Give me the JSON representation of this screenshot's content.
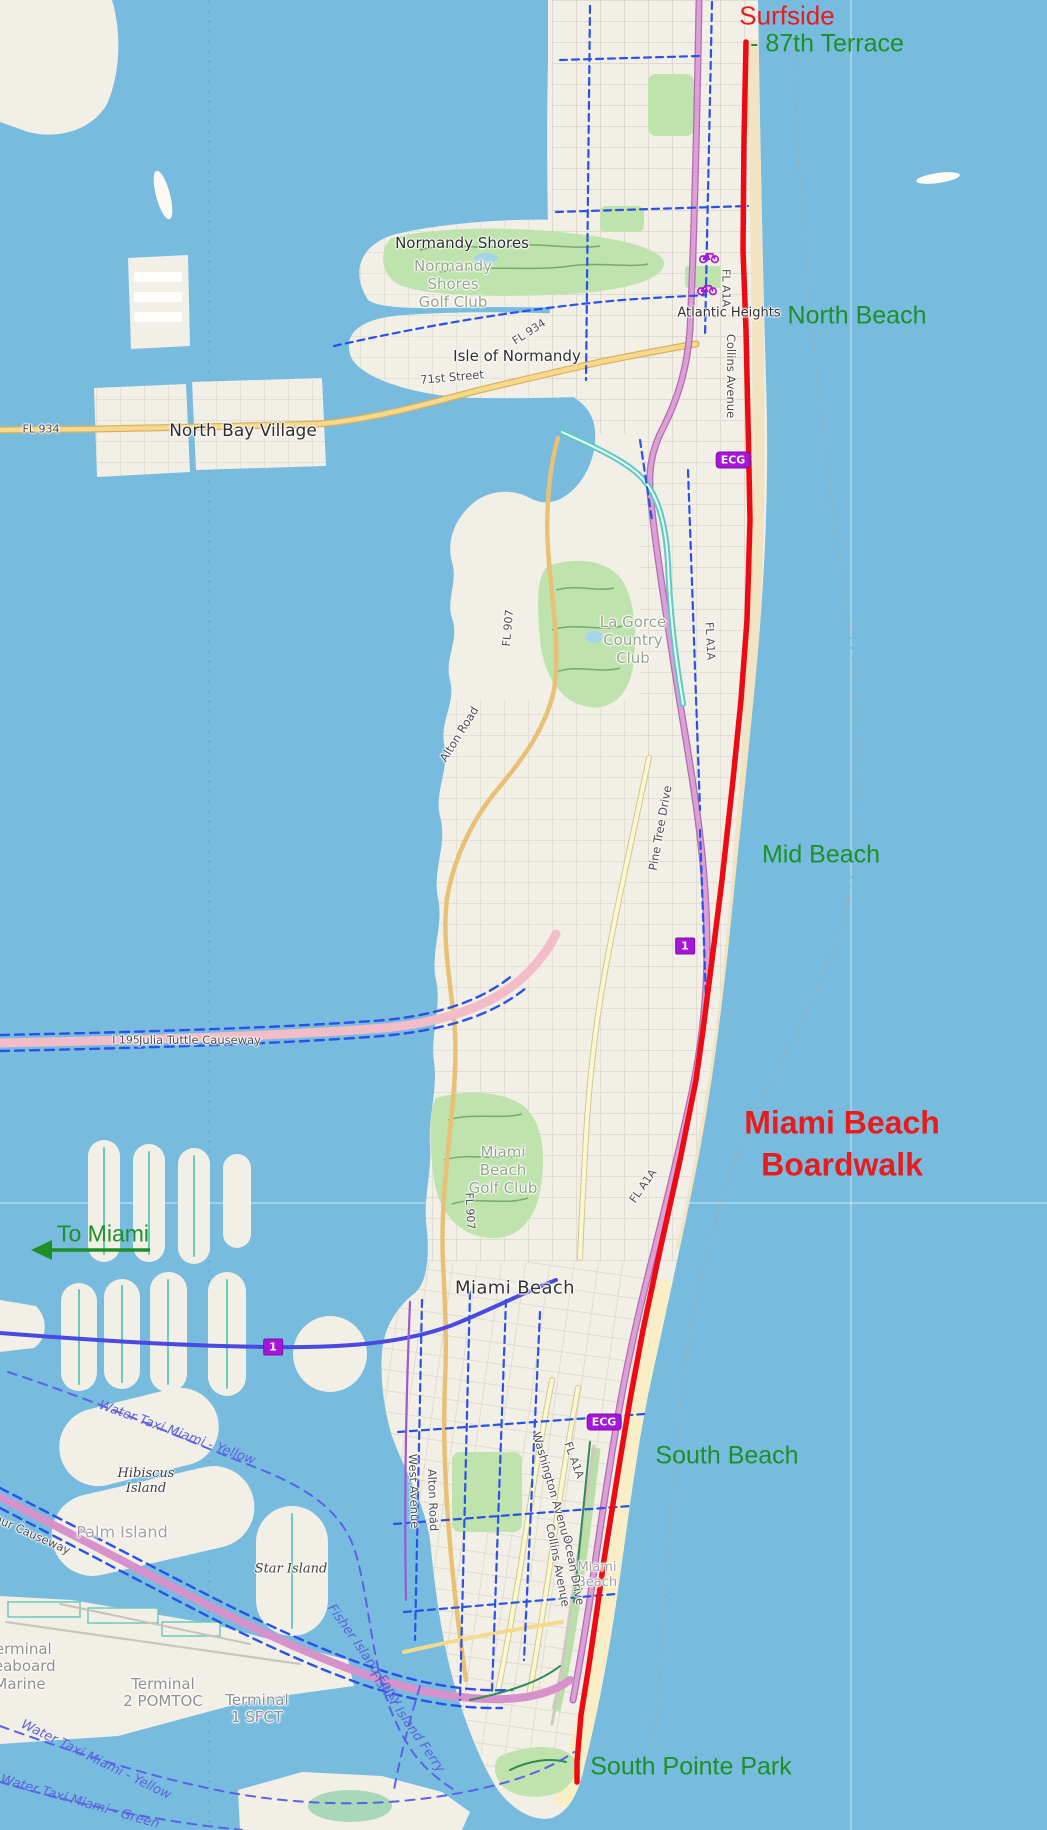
{
  "meta": {
    "width": 1047,
    "height": 1830,
    "description": "Annotated OpenStreetMap-style map of Miami Beach showing the Miami Beach Boardwalk route in red from Surfside / 87th Terrace to South Pointe Park"
  },
  "map": {
    "colors": {
      "water": "#77bbdf",
      "land": "#f2efe6",
      "sand": "#f2e3c2",
      "sand_south": "#faeec6",
      "park": "#bfe3ad",
      "golf_contour": "#7aa96c",
      "road_yellow": "#f6d98c",
      "road_pale": "#faf7d2",
      "road_mauve": "#dba0d6",
      "causeway_pink": "#f2bcc9",
      "causeway_magenta": "#d892cb",
      "teal_road": "#5ecac0",
      "bike_blue": "#2a52e8",
      "taxi_blue": "#5b62e8",
      "boardwalk_red": "#ee0a12",
      "annotation_red": "#e81c1c",
      "annotation_green": "#1d9027",
      "badge_purple": "#a615d8",
      "grid": "#d9d3c8"
    },
    "labels": [
      {
        "n": "annotation-surfside",
        "t": "Surfside",
        "x": 787,
        "y": 16,
        "r": "ann-red"
      },
      {
        "n": "annotation-87th-terrace",
        "t": "- 87th Terrace",
        "x": 827,
        "y": 44,
        "r": "ann-green"
      },
      {
        "n": "annotation-north-beach",
        "t": "North Beach",
        "x": 857,
        "y": 316,
        "r": "ann-green"
      },
      {
        "n": "annotation-mid-beach",
        "t": "Mid Beach",
        "x": 821,
        "y": 855,
        "r": "ann-green"
      },
      {
        "n": "annotation-boardwalk-title",
        "t": "Miami Beach\nBoardwalk",
        "x": 842,
        "y": 1144,
        "r": "ann-red-big"
      },
      {
        "n": "annotation-to-miami",
        "t": "To Miami",
        "x": 103,
        "y": 1234,
        "r": "ann-green",
        "s": 23
      },
      {
        "n": "annotation-south-beach",
        "t": "South Beach",
        "x": 727,
        "y": 1456,
        "r": "ann-green"
      },
      {
        "n": "annotation-south-pointe-park",
        "t": "South Pointe Park",
        "x": 691,
        "y": 1767,
        "r": "ann-green"
      },
      {
        "n": "label-normandy-shores",
        "t": "Normandy Shores",
        "x": 462,
        "y": 243,
        "r": "place halo"
      },
      {
        "n": "label-normandy-shores-golf-club",
        "t": "Normandy\nShores\nGolf Club",
        "x": 453,
        "y": 284,
        "r": "golf halo"
      },
      {
        "n": "label-isle-of-normandy",
        "t": "Isle of Normandy",
        "x": 517,
        "y": 356,
        "r": "place halo"
      },
      {
        "n": "label-north-bay-village",
        "t": "North Bay Village",
        "x": 243,
        "y": 431,
        "r": "place-lg halo"
      },
      {
        "n": "label-atlantic-heights",
        "t": "Atlantic Heights",
        "x": 729,
        "y": 313,
        "r": "place-sm halo"
      },
      {
        "n": "label-miami-beach-city",
        "t": "Miami Beach",
        "x": 515,
        "y": 1288,
        "r": "city halo"
      },
      {
        "n": "label-miami-beach-faint",
        "t": "Miami\nBeach",
        "x": 597,
        "y": 1575,
        "r": "suburb-faint halo",
        "s": 13
      },
      {
        "n": "label-la-gorce-country-club",
        "t": "La Gorce\nCountry\nClub",
        "x": 633,
        "y": 640,
        "r": "golf halo"
      },
      {
        "n": "label-miami-beach-golf-club",
        "t": "Miami\nBeach\nGolf Club",
        "x": 503,
        "y": 1170,
        "r": "golf halo"
      },
      {
        "n": "label-hibiscus-island",
        "t": "Hibiscus\nIsland",
        "x": 146,
        "y": 1481,
        "r": "island halo"
      },
      {
        "n": "label-palm-island",
        "t": "Palm Island",
        "x": 122,
        "y": 1532,
        "r": "suburb-faint halo"
      },
      {
        "n": "label-star-island",
        "t": "Star Island",
        "x": 291,
        "y": 1569,
        "r": "island halo"
      },
      {
        "n": "label-terminal-seaboard-marine",
        "t": "Terminal\nSeaboard\nMarine",
        "x": 20,
        "y": 1667,
        "r": "terminal halo"
      },
      {
        "n": "label-terminal-2-pomtoc",
        "t": "Terminal\n2 POMTOC",
        "x": 163,
        "y": 1693,
        "r": "terminal halo"
      },
      {
        "n": "label-terminal-1-sfct",
        "t": "Terminal\n1 SFCT",
        "x": 257,
        "y": 1709,
        "r": "terminal halo"
      },
      {
        "n": "label-71st-street",
        "t": "71st Street",
        "x": 452,
        "y": 377,
        "r": "road halo",
        "rot": -5
      },
      {
        "n": "label-fl-934-isle",
        "t": "FL 934",
        "x": 529,
        "y": 332,
        "r": "ref halo",
        "rot": -33
      },
      {
        "n": "label-fl-934-west",
        "t": "FL 934",
        "x": 41,
        "y": 429,
        "r": "ref halo"
      },
      {
        "n": "label-collins-avenue-north",
        "t": "Collins Avenue",
        "x": 731,
        "y": 376,
        "r": "road halo",
        "rot": 90
      },
      {
        "n": "label-fl-a1a-north",
        "t": "FL A1A",
        "x": 726,
        "y": 288,
        "r": "ref halo",
        "rot": 90
      },
      {
        "n": "label-fl-a1a-mid",
        "t": "FL A1A",
        "x": 710,
        "y": 641,
        "r": "ref halo",
        "rot": 87
      },
      {
        "n": "label-fl-a1a-lower-mid",
        "t": "FL A1A",
        "x": 643,
        "y": 1186,
        "r": "ref halo",
        "rot": -55
      },
      {
        "n": "label-fl-a1a-south",
        "t": "FL A1A",
        "x": 574,
        "y": 1460,
        "r": "ref halo",
        "rot": 70
      },
      {
        "n": "label-alton-road-mid",
        "t": "Alton Road",
        "x": 459,
        "y": 734,
        "r": "road halo",
        "rot": -58
      },
      {
        "n": "label-alton-road-south",
        "t": "Alton Road",
        "x": 433,
        "y": 1500,
        "r": "road halo",
        "rot": 88
      },
      {
        "n": "label-west-avenue",
        "t": "West Avenue",
        "x": 414,
        "y": 1491,
        "r": "road halo",
        "rot": 88
      },
      {
        "n": "label-washington-avenue",
        "t": "Washington Avenue",
        "x": 552,
        "y": 1487,
        "r": "road halo",
        "rot": 74
      },
      {
        "n": "label-collins-avenue-south",
        "t": "Collins Avenue",
        "x": 558,
        "y": 1565,
        "r": "road halo",
        "rot": 79
      },
      {
        "n": "label-ocean-drive",
        "t": "Ocean Drive",
        "x": 574,
        "y": 1570,
        "r": "road halo",
        "rot": 79
      },
      {
        "n": "label-pine-tree-drive",
        "t": "Pine Tree Drive",
        "x": 660,
        "y": 828,
        "r": "road halo",
        "rot": -80
      },
      {
        "n": "label-fl-907-mid",
        "t": "FL 907",
        "x": 508,
        "y": 628,
        "r": "ref halo",
        "rot": -85
      },
      {
        "n": "label-fl-907-south",
        "t": "FL 907",
        "x": 470,
        "y": 1211,
        "r": "ref halo",
        "rot": 87
      },
      {
        "n": "label-i-195",
        "t": "I 195",
        "x": 126,
        "y": 1040,
        "r": "ref halo"
      },
      {
        "n": "label-julia-tuttle-causeway",
        "t": "Julia Tuttle Causeway",
        "x": 200,
        "y": 1040,
        "r": "road halo"
      },
      {
        "n": "label-macarthur-causeway",
        "t": "MacArthur Causeway",
        "x": 14,
        "y": 1526,
        "r": "road halo",
        "rot": 24
      },
      {
        "n": "label-fisher-island-ferry-1",
        "t": "Fisher Island Ferry",
        "x": 365,
        "y": 1655,
        "r": "water-route",
        "rot": 55
      },
      {
        "n": "label-fisher-island-ferry-2",
        "t": "Fisher Island Ferry",
        "x": 407,
        "y": 1722,
        "r": "water-route",
        "rot": 55
      },
      {
        "n": "label-water-taxi-yellow-1",
        "t": "Water Taxi Miami - Yellow",
        "x": 177,
        "y": 1433,
        "r": "water-route",
        "rot": 20
      },
      {
        "n": "label-water-taxi-yellow-2",
        "t": "Water Taxi Miami - Yellow",
        "x": 96,
        "y": 1760,
        "r": "water-route",
        "rot": 26
      },
      {
        "n": "label-water-taxi-green",
        "t": "Water Taxi Miami - Green",
        "x": 80,
        "y": 1802,
        "r": "water-route",
        "rot": 16
      }
    ],
    "badges": [
      {
        "n": "badge-ecg-north",
        "t": "ECG",
        "type": "ecg",
        "x": 733,
        "y": 460
      },
      {
        "n": "badge-ecg-south",
        "t": "ECG",
        "type": "ecg",
        "x": 604,
        "y": 1422
      },
      {
        "n": "badge-route-1-mid",
        "t": "1",
        "type": "route",
        "x": 685,
        "y": 946
      },
      {
        "n": "badge-route-1-venetian",
        "t": "1",
        "type": "route",
        "x": 273,
        "y": 1347
      }
    ],
    "icons": [
      {
        "name": "bicycle-icon",
        "x": 709,
        "y": 258
      },
      {
        "name": "bicycle-icon",
        "x": 707,
        "y": 290
      }
    ]
  }
}
